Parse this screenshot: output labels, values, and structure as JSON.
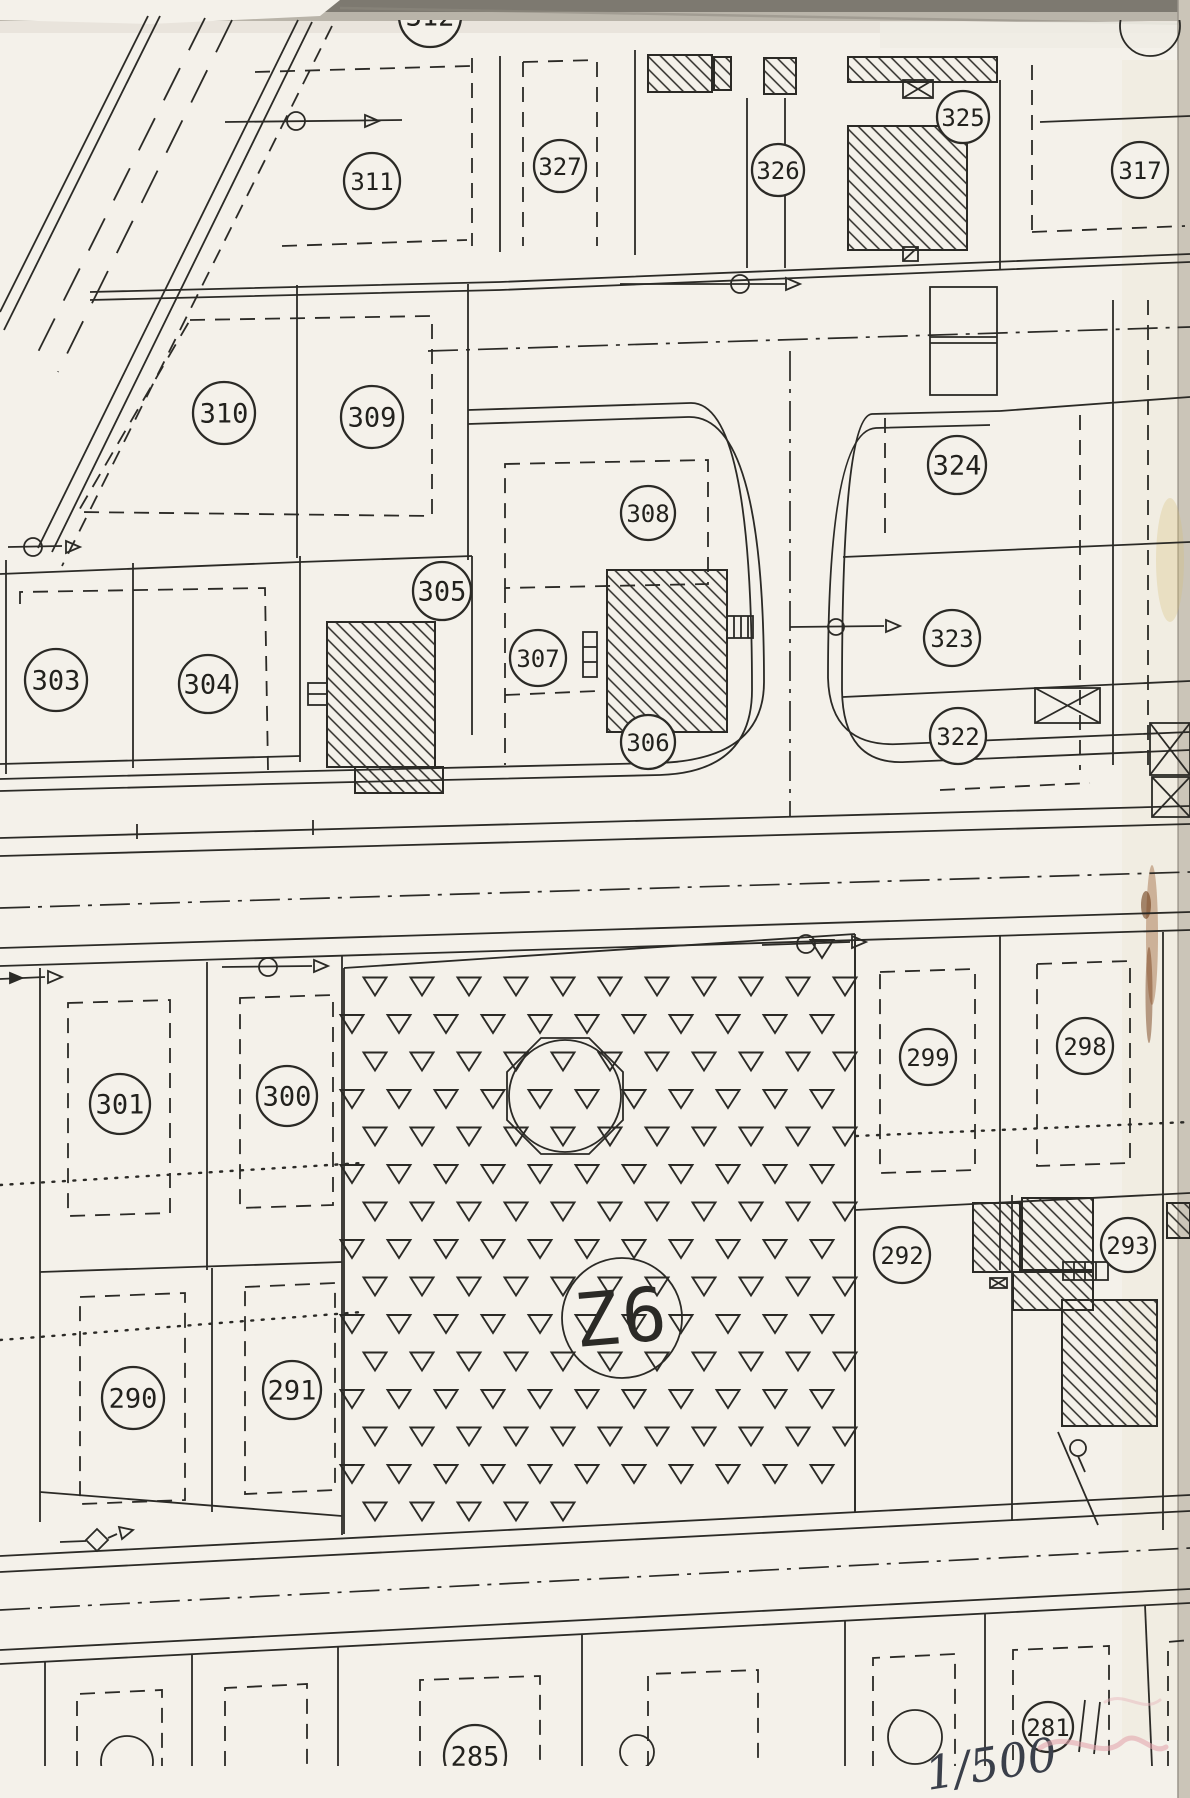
{
  "map": {
    "scale_note": "1/500",
    "zone": {
      "label": "Z6",
      "x": 622,
      "y": 1318,
      "r": 60
    },
    "parcels": [
      {
        "label": "312",
        "x": 430,
        "y": 16,
        "r": 31,
        "clip": "top"
      },
      {
        "label": "311",
        "x": 372,
        "y": 181,
        "r": 28
      },
      {
        "label": "327",
        "x": 560,
        "y": 166,
        "r": 26
      },
      {
        "label": "326",
        "x": 778,
        "y": 170,
        "r": 26
      },
      {
        "label": "325",
        "x": 963,
        "y": 117,
        "r": 26
      },
      {
        "label": "317",
        "x": 1140,
        "y": 170,
        "r": 28
      },
      {
        "label": "310",
        "x": 224,
        "y": 413,
        "r": 31
      },
      {
        "label": "309",
        "x": 372,
        "y": 417,
        "r": 31
      },
      {
        "label": "308",
        "x": 648,
        "y": 513,
        "r": 27
      },
      {
        "label": "324",
        "x": 957,
        "y": 465,
        "r": 29
      },
      {
        "label": "305",
        "x": 442,
        "y": 591,
        "r": 29
      },
      {
        "label": "307",
        "x": 538,
        "y": 658,
        "r": 28
      },
      {
        "label": "303",
        "x": 56,
        "y": 680,
        "r": 31
      },
      {
        "label": "304",
        "x": 208,
        "y": 684,
        "r": 29
      },
      {
        "label": "323",
        "x": 952,
        "y": 638,
        "r": 28
      },
      {
        "label": "306",
        "x": 648,
        "y": 742,
        "r": 27
      },
      {
        "label": "322",
        "x": 958,
        "y": 736,
        "r": 28
      },
      {
        "label": "301",
        "x": 120,
        "y": 1104,
        "r": 30
      },
      {
        "label": "300",
        "x": 287,
        "y": 1096,
        "r": 30
      },
      {
        "label": "299",
        "x": 928,
        "y": 1057,
        "r": 28
      },
      {
        "label": "298",
        "x": 1085,
        "y": 1046,
        "r": 28
      },
      {
        "label": "292",
        "x": 902,
        "y": 1255,
        "r": 28
      },
      {
        "label": "293",
        "x": 1128,
        "y": 1245,
        "r": 27
      },
      {
        "label": "290",
        "x": 133,
        "y": 1398,
        "r": 31
      },
      {
        "label": "291",
        "x": 292,
        "y": 1390,
        "r": 29
      },
      {
        "label": "281",
        "x": 1048,
        "y": 1727,
        "r": 25
      },
      {
        "label": "285",
        "x": 475,
        "y": 1756,
        "r": 31,
        "clip": "bottom"
      }
    ],
    "symbols": {
      "vegetation_fill": "open-triangle-pattern",
      "building_fill": "diagonal-hatch",
      "survey_marker": "circle-with-arrow",
      "utility_symbol": "crossed-box"
    },
    "colors": {
      "ink": "#2b2a26",
      "paper": "#f4f1ea"
    }
  }
}
